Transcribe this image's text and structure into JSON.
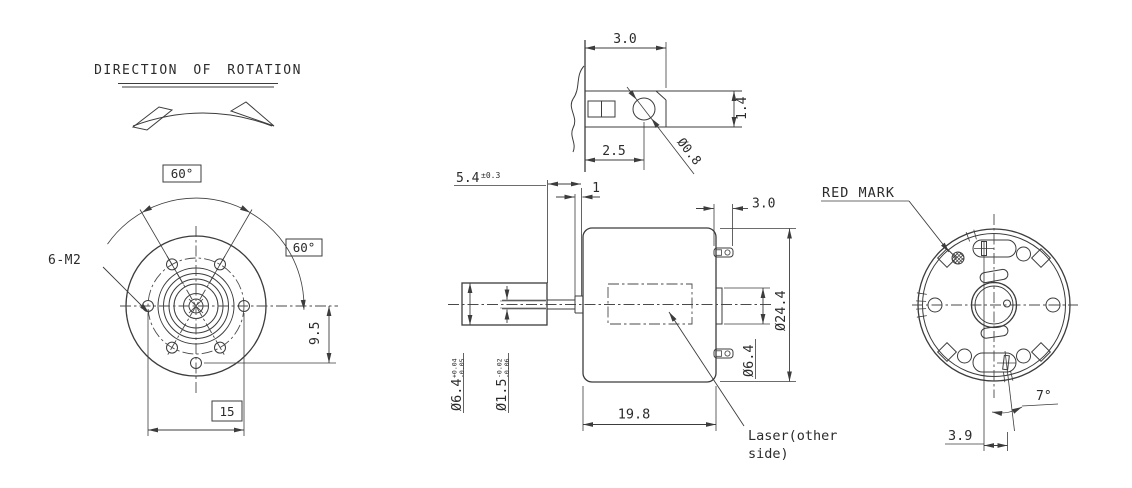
{
  "front_view": {
    "title": "DIRECTION OF ROTATION",
    "thread_callout": "6-M2",
    "angle_top": "60°",
    "angle_side": "60°",
    "hole_offset": "9.5",
    "mount_width": "15"
  },
  "terminal_detail": {
    "tab_length": "3.0",
    "hole_position": "2.5",
    "tab_width": "1.4",
    "hole_dia": "Ø0.8"
  },
  "side_view": {
    "shaft_ext": "5.4",
    "shaft_ext_tol": "±0.3",
    "washer": "1",
    "tab_proj": "3.0",
    "body_dia": "Ø24.4",
    "rear_boss_dia": "Ø6.4",
    "front_boss_dia": "Ø6.4",
    "front_boss_tol_hi": "+0.04",
    "front_boss_tol_lo": "-0.05",
    "shaft_dia": "Ø1.5",
    "shaft_tol_hi": "-0.02",
    "shaft_tol_lo": "-0.06",
    "body_length": "19.8",
    "laser_note_1": "Laser(other",
    "laser_note_2": "side)"
  },
  "rear_view": {
    "red_mark": "RED MARK",
    "pin_angle": "7°",
    "pin_offset": "3.9"
  }
}
